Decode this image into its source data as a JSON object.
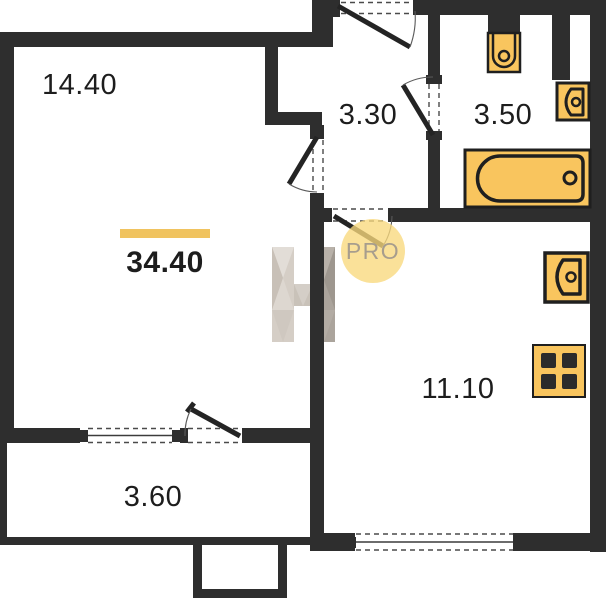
{
  "floorplan": {
    "total_area": "34.40",
    "rooms": {
      "living": "14.40",
      "hall": "3.30",
      "bathroom": "3.50",
      "kitchen": "11.10",
      "balcony": "3.60"
    },
    "watermarks": {
      "pro": "PRO"
    },
    "colors": {
      "wall": "#2e2e2e",
      "fixture_fill": "#f9c55e",
      "fixture_stroke": "#1f1f1f",
      "accent_bar": "#f0c35f",
      "pro_circle": "#f8d97c",
      "pro_text": "#a39a8d",
      "label_text": "#1d1d1d"
    }
  }
}
